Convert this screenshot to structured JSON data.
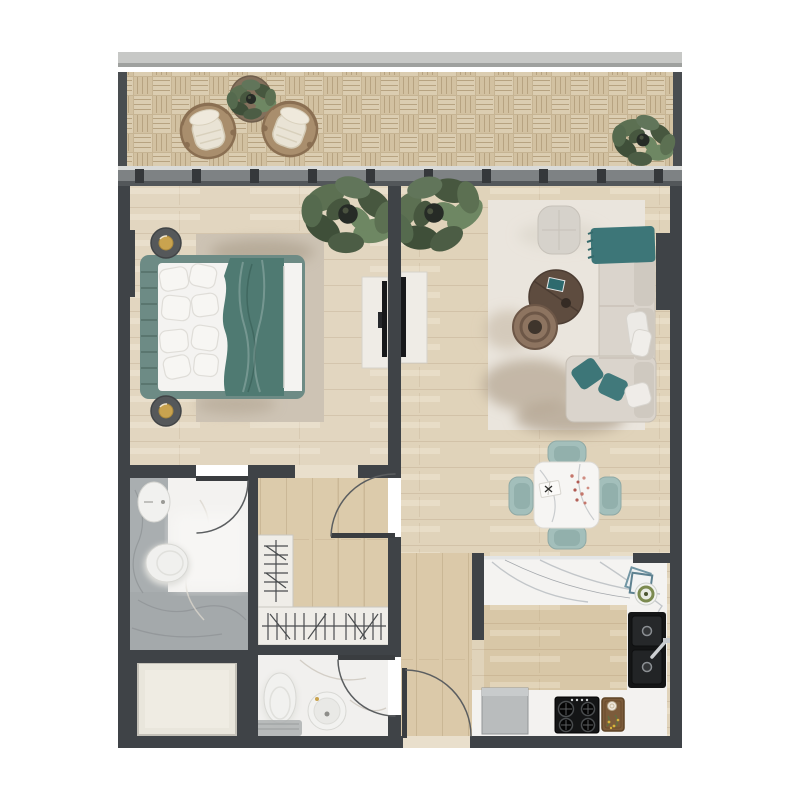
{
  "scene": {
    "title": "one-bedroom apartment floor plan",
    "view": "top-down 2D architectural render",
    "visible_text": [],
    "rooms": [
      {
        "name": "balcony",
        "position": "top",
        "features": [
          "basket-weave wood decking",
          "two round wicker lounge chairs with cream cushions",
          "round side table with potted plant",
          "potted plant at right end",
          "light gray parapet rail"
        ]
      },
      {
        "name": "bedroom",
        "position": "upper-left",
        "features": [
          "double bed with teal blanket and white pillows",
          "tufted teal headboard",
          "two round nightstands with brass lamps",
          "beige area rug",
          "potted plant",
          "white media console with wall TV"
        ]
      },
      {
        "name": "living-room",
        "position": "upper-right",
        "features": [
          "cream corner sofa with teal throw and teal cushions",
          "dark round coffee table",
          "brown ring side table",
          "light gray floor pouf",
          "cream shaggy rug with taupe mottling",
          "potted plant",
          "white media console with wall TV"
        ]
      },
      {
        "name": "dining-area",
        "position": "center-right",
        "features": [
          "square white marble dining table",
          "four teal dining chairs",
          "open book",
          "scattered petals"
        ]
      },
      {
        "name": "kitchen",
        "position": "lower-right",
        "features": [
          "L-shaped white marble counter",
          "black double-basin sink with chrome faucet",
          "black four-burner hob",
          "wood cutting board with herbs",
          "gray dishwasher",
          "stacked teal plates"
        ]
      },
      {
        "name": "bathroom-ensuite",
        "position": "mid-left",
        "features": [
          "oval countertop basin",
          "toilet",
          "gray marble shower zone",
          "inward swing door"
        ]
      },
      {
        "name": "hallway-closet",
        "position": "center",
        "features": [
          "wardrobe with hanging rail on left",
          "wardrobe with hanging rail at bottom",
          "swing door from entry corridor"
        ]
      },
      {
        "name": "bathroom-guest",
        "position": "lower-center",
        "features": [
          "toilet",
          "round basin",
          "gray bath mat",
          "inward swing door"
        ]
      },
      {
        "name": "entry-corridor",
        "position": "bottom-center",
        "features": [
          "entrance swing door in bottom wall"
        ]
      },
      {
        "name": "utility-shaft",
        "position": "bottom-left",
        "features": [
          "enclosed cream service box"
        ]
      }
    ],
    "doors": [
      {
        "room": "bathroom-ensuite",
        "type": "swing"
      },
      {
        "room": "hallway-closet",
        "type": "swing"
      },
      {
        "room": "bathroom-guest",
        "type": "swing"
      },
      {
        "room": "entry-corridor",
        "type": "swing"
      }
    ],
    "window_wall": {
      "mullion_count": 10,
      "location": "between balcony and bedroom/living room"
    }
  },
  "palette": {
    "wall": "#3f4347",
    "wood": "#e2d6c0",
    "wood_warm": "#dbc9a9",
    "kitchen_floor": "#d8c7a7",
    "balcony_tile": "#d7c7aa",
    "rail": "#c7c8c6",
    "window_band": "#7e8284",
    "marble_white": "#f3f2f0",
    "marble_gray": "#a9aeb0",
    "rug_beige": "#cdc3b4",
    "rug_cream": "#eae5dd",
    "teal": "#4f7a72",
    "teal_throw": "#3d7678",
    "chair_teal": "#a3bfbb",
    "cream": "#dad4cc",
    "console": "#efece6",
    "appliance_black": "#141516",
    "appliance_gray": "#b9bcbd",
    "wardrobe": "#efede8",
    "leaf_green": "#5c7052",
    "table_brown": "#5e4c3f",
    "wicker": "#a98e6d",
    "lamp_gold": "#c9a34f",
    "white": "#f4f3f1",
    "threshold": "#e9dfcc"
  }
}
